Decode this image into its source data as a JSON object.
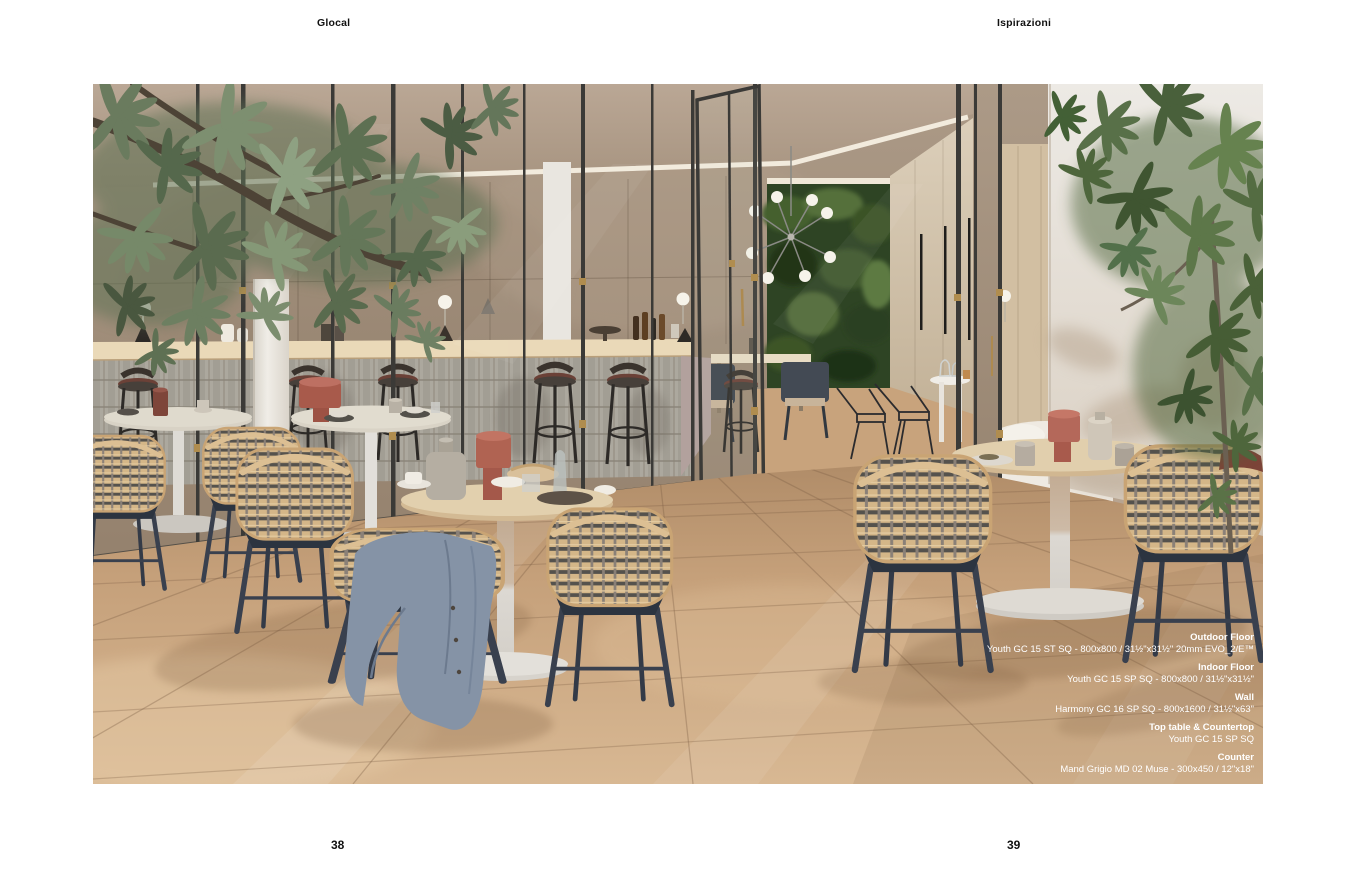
{
  "header": {
    "collection": "Glocal",
    "section": "Ispirazioni"
  },
  "pagination": {
    "left": "38",
    "right": "39"
  },
  "specs": [
    {
      "label": "Outdoor Floor",
      "value": "Youth GC 15 ST SQ - 800x800 / 31½\"x31½\" 20mm EVO_2/E™"
    },
    {
      "label": "Indoor Floor",
      "value": "Youth GC 15 SP SQ - 800x800 / 31½\"x31½\""
    },
    {
      "label": "Wall",
      "value": "Harmony GC 16 SP SQ - 800x1600 / 31½\"x63\""
    },
    {
      "label": "Top table & Countertop",
      "value": "Youth GC 15 SP SQ"
    },
    {
      "label": "Counter",
      "value": "Mand Grigio MD 02 Muse - 300x450 / 12\"x18\""
    }
  ],
  "palette": {
    "floor_tan": "#c9a47e",
    "wall_beige": "#a79482",
    "green_wall": "#2e4424",
    "terracotta": "#a85a4b",
    "wicker": "#d3b586",
    "navy": "#3a4150",
    "spec_text": "#ffffff"
  }
}
